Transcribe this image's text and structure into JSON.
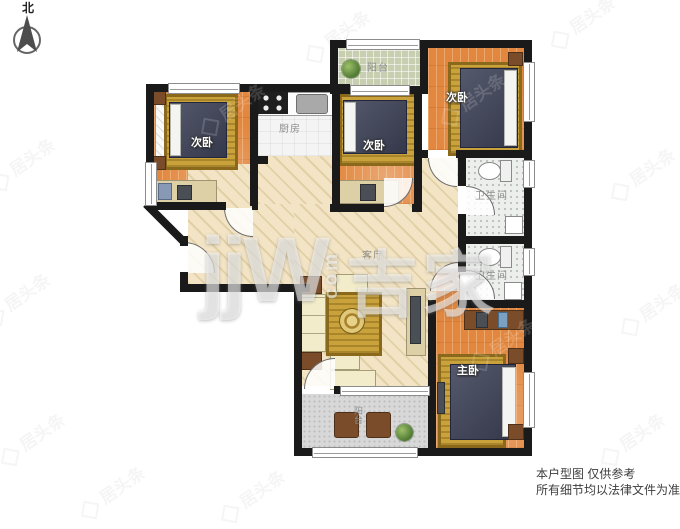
{
  "meta": {
    "type": "residential-floor-plan"
  },
  "compass": {
    "label": "北"
  },
  "rooms": {
    "bedroom_left": {
      "label": "次卧"
    },
    "kitchen": {
      "label": "厨房"
    },
    "balcony_top": {
      "label": "阳台"
    },
    "bedroom_mid": {
      "label": "次卧"
    },
    "bedroom_right": {
      "label": "次卧"
    },
    "bathroom_upper": {
      "label": "卫生间"
    },
    "bathroom_lower": {
      "label": "卫生间"
    },
    "living": {
      "label": "客厅"
    },
    "master": {
      "label": "主卧"
    },
    "balcony_bottom": {
      "label": "阳台"
    }
  },
  "watermarks": {
    "brand_latin": "jjW",
    "brand_domain": "com",
    "brand_cn": "吉家",
    "tile_text": "居头条"
  },
  "disclaimer": {
    "line1": "本户型图 仅供参考",
    "line2": "所有细节均以法律文件为准"
  },
  "colors": {
    "wall": "#1a1a1a",
    "wood_floor": "#e2873f",
    "living_floor": "#f2e4c4",
    "balcony_top_floor": "#c7cfb0",
    "tile_floor": "#edefed",
    "balcony_bottom_floor": "#d8d8d8",
    "rug_gold": "#c9a23c",
    "bed": "#3d4257",
    "label_gray": "#8f8f8f"
  }
}
